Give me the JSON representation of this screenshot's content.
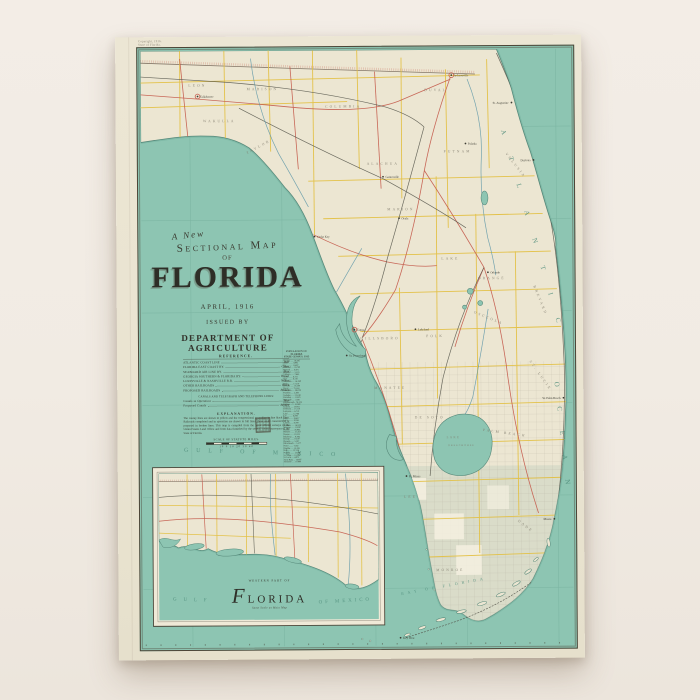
{
  "colors": {
    "page_bg": "#f1ebe3",
    "poster_paper": "#ebe5d3",
    "ocean": "#8dc5b2",
    "land": "#ece6d2",
    "county_line_yellow": "#e3c043",
    "railroad_red": "#c4594a",
    "railroad_dark": "#54544a",
    "river_blue": "#5e97a8",
    "ink": "#33332a"
  },
  "poster": {
    "margin_notes": {
      "line1": "Copyright, 1916.",
      "line2": "State of Florida."
    },
    "title_block": {
      "line1": "A New",
      "line2": "Sectional Map",
      "line3": "OF",
      "title": "FLORIDA",
      "date": "APRIL, 1916",
      "issued": "ISSUED BY",
      "department": "DEPARTMENT OF AGRICULTURE"
    },
    "reference": {
      "header": "REFERENCE.",
      "entries": [
        {
          "name": "ATLANTIC COAST LINE",
          "color": "Red"
        },
        {
          "name": "FLORIDA EAST COAST RY.",
          "color": "Green"
        },
        {
          "name": "SEABOARD AIR LINE RY.",
          "color": "Blue"
        },
        {
          "name": "GEORGIA SOUTHERN & FLORIDA RY.",
          "color": "Brown"
        },
        {
          "name": "LOUISVILLE & NASHVILLE R.R.",
          "color": "Yellow"
        },
        {
          "name": "OTHER RAILROADS",
          "color": "Black"
        },
        {
          "name": "PROPOSED RAILROADS",
          "color": "Broken"
        }
      ],
      "sub_header": "CANALS AND TELEGRAPH AND TELEPHONE LINES:",
      "sub_entries": [
        {
          "name": "Canals in Operation",
          "color": "Blue"
        },
        {
          "name": "Proposed Canals",
          "color": "Broken"
        }
      ]
    },
    "explanation": {
      "header": "EXPLANATION.",
      "text": "The county lines are shown in yellow and the congressional townships in fine black lines. Railroads completed and in operation are shown in full lines, those under construction or proposed in broken lines. This map is compiled from the latest official surveys of the United States Land Office and from data furnished by the several county surveyors of the State of Florida."
    },
    "scale": {
      "label": "SCALE OF STATUTE MILES.",
      "ticks": "10   0   10   20   30   40"
    },
    "county_table": {
      "header1": "POPULATION OF FLORIDA",
      "header2": "STATE CENSUS, 1915",
      "rows": [
        "Alachua ...... 34,305",
        "Baker ........ 4,805",
        "Bay .......... 11,407",
        "Bradford ..... 18,700",
        "Brevard ...... 6,475",
        "Broward ...... 5,135",
        "Calhoun ...... 7,465",
        "Citrus ....... 6,731",
        "Clay ......... 6,116",
        "Columbia ..... 14,290",
        "Dade ......... 17,510",
        "De Soto ...... 14,200",
        "Duval ........ 75,163",
        "Escambia ..... 38,029",
        "Franklin ..... 5,360",
        "Gadsden ...... 22,198",
        "Hamilton ..... 11,825",
        "Hernando ..... 5,641",
        "Hillsborough . 78,374",
        "Holmes ....... 12,060",
        "Jackson ...... 29,821",
        "Jefferson .... 17,210",
        "Lafayette .... 6,710",
        "Lake ......... 12,744",
        "Lee .......... 6,294",
        "Leon ......... 19,427",
        "Levy ......... 10,361",
        "Liberty ...... 4,700",
        "Madison ...... 16,919",
        "Manatee ...... 11,030",
        "Marion ....... 26,943",
        "Monroe ....... 21,563",
        "Nassau ....... 10,525",
        "Okaloosa ..... 9,360",
        "Orange ....... 19,107",
        "Osceola ...... 5,507",
        "Palm Beach ... 5,577",
        "Pasco ........ 7,362",
        "Pinellas ..... 13,193",
        "Polk ......... 37,154",
        "Putnam ....... 13,096",
        "St. Johns .... 13,208",
        "St. Lucie .... 4,075",
        "Santa Rosa ... 14,897",
        "Seminole ..... 10,986",
        "Sumter ....... 6,696",
        "Suwannee ..... 18,603",
        "Taylor ....... 7,103",
        "Volusia ...... 16,510",
        "Wakulla ...... 4,802",
        "Walton ....... 16,460",
        "Washington ... 16,403"
      ],
      "footer": "Total .... 921,618"
    },
    "inset": {
      "caption_top": "WESTERN PART OF",
      "caption_title": "Florida",
      "caption_sub": "Same Scale as Main Map"
    }
  },
  "sea": {
    "atlantic": "ATLANTIC",
    "ocean": "OCEAN",
    "gulf_main": "GULF OF MEXICO",
    "gulf_inset_a": "GULF",
    "gulf_inset_b": "OF MEXICO",
    "bay": "BAY OF FLORIDA",
    "lake1": "LAKE",
    "lake2": "OKEECHOBEE"
  },
  "labels": {
    "regions": [
      {
        "t": "LEON",
        "x": 58,
        "y": 36,
        "r": 0
      },
      {
        "t": "WAKULLA",
        "x": 80,
        "y": 72,
        "r": 0
      },
      {
        "t": "MADISON",
        "x": 124,
        "y": 40,
        "r": 0
      },
      {
        "t": "TAYLOR",
        "x": 120,
        "y": 98,
        "r": -28
      },
      {
        "t": "COLUMBIA",
        "x": 206,
        "y": 58,
        "r": 0
      },
      {
        "t": "DUVAL",
        "x": 300,
        "y": 42,
        "r": 0
      },
      {
        "t": "ALACHUA",
        "x": 246,
        "y": 116,
        "r": 0
      },
      {
        "t": "PUTNAM",
        "x": 322,
        "y": 104,
        "r": 0
      },
      {
        "t": "MARION",
        "x": 264,
        "y": 162,
        "r": 0
      },
      {
        "t": "VOLUSIA",
        "x": 380,
        "y": 118,
        "r": 52
      },
      {
        "t": "LAKE",
        "x": 314,
        "y": 212,
        "r": 0
      },
      {
        "t": "ORANGE",
        "x": 356,
        "y": 232,
        "r": 0
      },
      {
        "t": "BREVARD",
        "x": 404,
        "y": 254,
        "r": 68
      },
      {
        "t": "OSCEOLA",
        "x": 352,
        "y": 272,
        "r": 22
      },
      {
        "t": "HILLSBORO",
        "x": 242,
        "y": 292,
        "r": 0
      },
      {
        "t": "POLK",
        "x": 298,
        "y": 290,
        "r": 0
      },
      {
        "t": "MANATEE",
        "x": 252,
        "y": 342,
        "r": 0
      },
      {
        "t": "DE SOTO",
        "x": 292,
        "y": 372,
        "r": 0
      },
      {
        "t": "ST. LUCIE",
        "x": 404,
        "y": 330,
        "r": 55
      },
      {
        "t": "PALM BEACH",
        "x": 368,
        "y": 388,
        "r": 8
      },
      {
        "t": "LEE",
        "x": 272,
        "y": 452,
        "r": 0
      },
      {
        "t": "DADE",
        "x": 388,
        "y": 482,
        "r": 38
      },
      {
        "t": "MONROE",
        "x": 312,
        "y": 526,
        "r": 0
      },
      {
        "t": "WALTON",
        "x": 98,
        "y": 462,
        "r": 0
      },
      {
        "t": "WASHINGTON",
        "x": 146,
        "y": 472,
        "r": -6
      },
      {
        "t": "JACKSON",
        "x": 205,
        "y": 444,
        "r": 0
      }
    ],
    "cities": [
      {
        "n": "Jacksonville",
        "x": 316,
        "y": 26,
        "big": 1,
        "a": "s"
      },
      {
        "n": "St. Augustine",
        "x": 377,
        "y": 54,
        "a": "e"
      },
      {
        "n": "Palatka",
        "x": 330,
        "y": 95,
        "a": "s"
      },
      {
        "n": "Gainesville",
        "x": 246,
        "y": 128,
        "a": "s"
      },
      {
        "n": "Ocala",
        "x": 262,
        "y": 170,
        "a": "s"
      },
      {
        "n": "Daytona",
        "x": 399,
        "y": 112,
        "a": "e"
      },
      {
        "n": "Orlando",
        "x": 352,
        "y": 225,
        "a": "s"
      },
      {
        "n": "Tampa",
        "x": 216,
        "y": 282,
        "big": 1,
        "a": "s"
      },
      {
        "n": "St. Petersburg",
        "x": 208,
        "y": 308,
        "a": "s"
      },
      {
        "n": "Lakeland",
        "x": 278,
        "y": 282,
        "a": "s"
      },
      {
        "n": "Cedar Key",
        "x": 176,
        "y": 188,
        "a": "s"
      },
      {
        "n": "Ft. Myers",
        "x": 268,
        "y": 430,
        "a": "s"
      },
      {
        "n": "W. Palm Beach",
        "x": 428,
        "y": 352,
        "a": "e"
      },
      {
        "n": "Miami",
        "x": 418,
        "y": 474,
        "a": "e"
      },
      {
        "n": "Key West",
        "x": 261,
        "y": 593,
        "a": "s"
      },
      {
        "n": "Tallahassee",
        "x": 58,
        "y": 46,
        "big": 1,
        "a": "s"
      },
      {
        "n": "Pensacola",
        "x": 33,
        "y": 488,
        "big": 1,
        "a": "s"
      },
      {
        "n": "Apalachicola",
        "x": 210,
        "y": 544,
        "a": "e"
      }
    ]
  }
}
